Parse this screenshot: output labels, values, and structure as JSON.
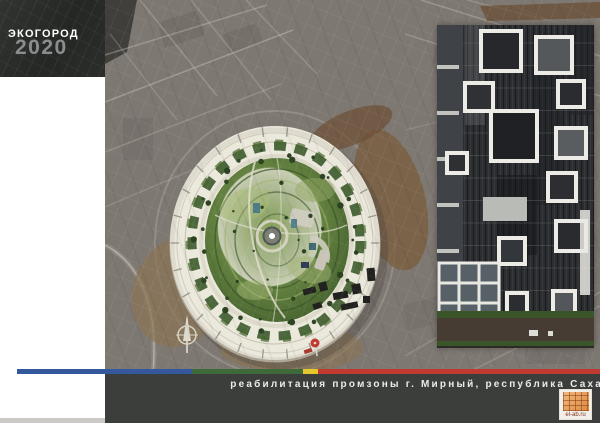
{
  "board": {
    "title": "ЭКОГОРОД",
    "year": "2020",
    "caption": "реабилитация промзоны г. Мирный, республика Саха",
    "logo": {
      "text": "el-ab.ru"
    }
  },
  "colors": {
    "title_box_bg": "#282a28",
    "title_text": "#ffffff",
    "year_text": "#8f9394",
    "map_bg": "#7e7872",
    "bottom_bar_bg": "#3b3e3a",
    "caption_text": "#ebebe9",
    "stripe": {
      "blue": "#33589b",
      "green": "#3e6a39",
      "yellow": "#e6c72d",
      "red": "#c23a2f"
    },
    "crater_rim": "#ebe8dc",
    "crater_green": "#5d7c41",
    "logo_orange": "#e0914a",
    "left_column_bg": "#ffffff"
  }
}
